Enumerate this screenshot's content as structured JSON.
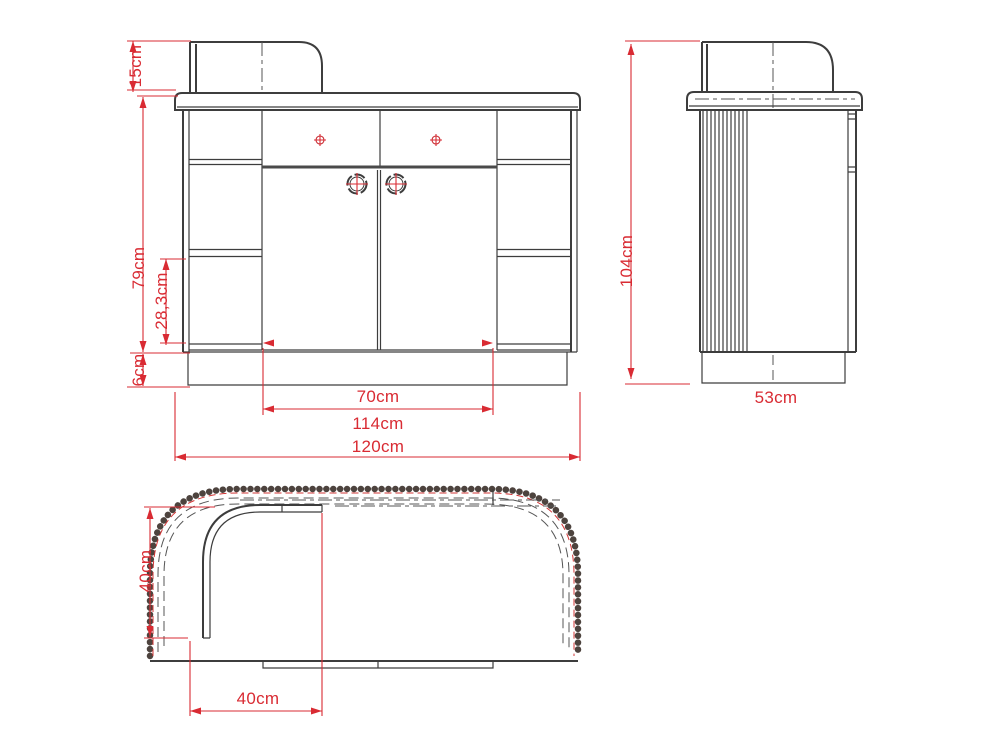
{
  "dimensions": {
    "front": {
      "shelf_height": "15cm",
      "body_height": "79cm",
      "compartment_height": "28,3cm",
      "plinth_height": "6cm",
      "doors_width": "70cm",
      "body_width": "114cm",
      "total_width": "120cm"
    },
    "side": {
      "total_height": "104cm",
      "depth": "53cm"
    },
    "top": {
      "counter_depth": "40cm",
      "counter_return_width": "40cm"
    }
  },
  "colors": {
    "dimension_red": "#d92b33",
    "drawing_line": "#3d3d3d",
    "bead_trim": "#4d433e"
  }
}
